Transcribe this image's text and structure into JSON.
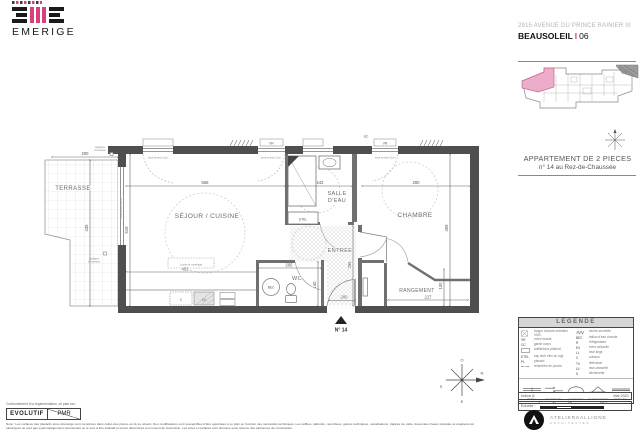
{
  "meta": {
    "brand": "EMERIGE"
  },
  "header": {
    "address": "2915 AVENUE DU PRINCE RAINIER III",
    "city": "BEAUSOLEIL",
    "sep": "I",
    "dept": "06"
  },
  "panel": {
    "title": "APPARTEMENT DE 2 PIECES",
    "subtitle": "n° 14 au Rez-de-Chaussée",
    "indice": "Indice A",
    "date": "Mai 2021",
    "echelle": "Echelle :",
    "scale": {
      "t0": "0",
      "t1": "50",
      "t2": "100",
      "t3": "200cm"
    },
    "architects": {
      "name": "ATELIERSALLIONE",
      "sub": "ARCHITECTES"
    }
  },
  "legend": {
    "title": "LEGENDE",
    "left": [
      {
        "abbr": "",
        "desc": "trappe d'accès entretien VMC"
      },
      {
        "abbr": "VR",
        "desc": "volet roulant"
      },
      {
        "abbr": "GC",
        "desc": "garde corps"
      },
      {
        "abbr": "",
        "desc": "soffite/faux plafond"
      },
      {
        "abbr": "ETEL",
        "desc": "esp tech elec du logt"
      },
      {
        "abbr": "PL",
        "desc": "placard"
      },
      {
        "abbr": "",
        "desc": "retombée de poutre"
      }
    ],
    "right": [
      {
        "abbr": "",
        "desc": "sèche-serviette"
      },
      {
        "abbr": "BEC",
        "desc": "ballon d'eau chaude"
      },
      {
        "abbr": "R",
        "desc": "réfrigérateur"
      },
      {
        "abbr": "EV",
        "desc": "évier vaisselle"
      },
      {
        "abbr": "LL",
        "desc": "lave-linge"
      },
      {
        "abbr": "C",
        "desc": "cuisson"
      },
      {
        "abbr": "TV",
        "desc": "télévision"
      },
      {
        "abbr": "LV",
        "desc": "lave-vaisselle"
      },
      {
        "abbr": "K",
        "desc": "kitchenette"
      }
    ],
    "windows": [
      "fenêtre",
      "pf coulissante",
      "porte fenêtre",
      "fe châssis battant",
      "fenêtre fixe"
    ]
  },
  "plan": {
    "rooms": {
      "terrasse": "TERRASSE",
      "sejour": "SÉJOUR / CUISINE",
      "salle1": "SALLE",
      "salle2": "D'EAU",
      "chambre": "CHAMBRE",
      "entree": "ENTRÉE",
      "wc": "WC",
      "rangement": "RANGEMENT"
    },
    "dims": {
      "terrasse_w": "200",
      "terrasse_h": "435",
      "sejour_h": "519",
      "sejour_w": "558",
      "salle_w": "242",
      "chambre_w": "280",
      "chambre_h": "409",
      "entree_h": "295",
      "wc_w": "205",
      "wc_h": "140",
      "carrelage": "453",
      "rangement_w": "217",
      "rangement_h": "100",
      "porte": "200"
    },
    "labels": {
      "etel": "ETEL",
      "gc": "GC",
      "vr": "VR",
      "bec": "BEC",
      "lv": "LV",
      "c": "C",
      "seuil": "seuil environ 2cm",
      "applique1": "Applique",
      "applique2": "lumineuse",
      "carrelage": "Limite de carrelage",
      "door": "N° 14"
    },
    "compass": {
      "n": "N",
      "s": "S",
      "e": "E",
      "o": "O"
    }
  },
  "footer": {
    "conformity": "Conformément à la réglementation, ce plan est :",
    "evolutif": "EVOLUTIF",
    "pmr": "PMR",
    "nota": "Nota : Les surfaces des placards et/ou dressings sont comprises dans celles des pièces où ils se situent. Des modifications sont susceptibles d'être apportées à ce plan en fonction des nécessités techniques. Les soffites, plafonds, retombées, gaines techniques, canalisations, trappes de visite, descentes d'eaux pluviales et équipements électriques ne sont pas systématiquement représentés ou le sont à titre indicatif et seront déterminés au moment de l'exécution. Les cotes et surfaces sont données sous réserve des tolérances de construction."
  },
  "colors": {
    "pink": "#d6417f",
    "wall": "#4f4f4f"
  }
}
